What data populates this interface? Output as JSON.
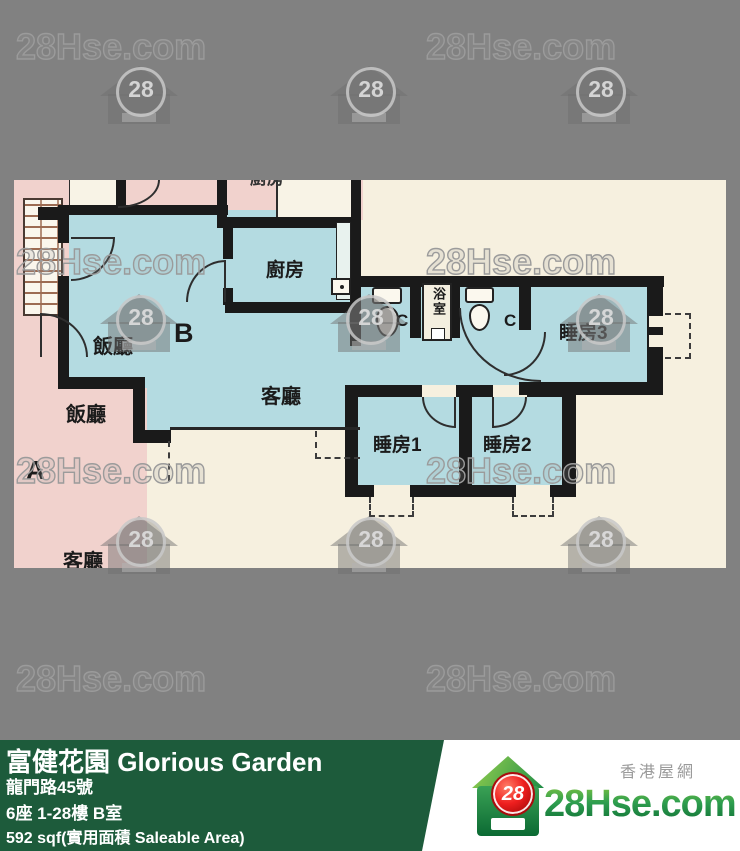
{
  "watermark": {
    "text": "28Hse.com",
    "badge_number": "28"
  },
  "plan": {
    "unit_a": {
      "name": "A",
      "dining": "飯廳",
      "living": "客廳"
    },
    "unit_b": {
      "name": "B",
      "dining": "飯廳",
      "kitchen": "廚房",
      "living": "客廳",
      "bathroom": "浴室",
      "bedroom1": "睡房1",
      "bedroom2": "睡房2",
      "bedroom3": "睡房3",
      "wc_mark": "C"
    },
    "adjacent_room": "廚房"
  },
  "info": {
    "title": "富健花園 Glorious Garden",
    "address": "龍門路45號",
    "unit": "6座 1-28樓 B室",
    "area": "592 sqf(實用面積 Saleable Area)"
  },
  "brand": {
    "site": "28Hse.com",
    "tagline": "香港屋網",
    "badge": "28"
  },
  "colors": {
    "background_gray": "#818181",
    "panel_green": "#1d5b3b",
    "badge_red": "#ef1f1f",
    "unit_b_fill": "#b4dbe1",
    "unit_a_fill": "#f1d2cd",
    "plan_paper": "#f6f0df"
  }
}
